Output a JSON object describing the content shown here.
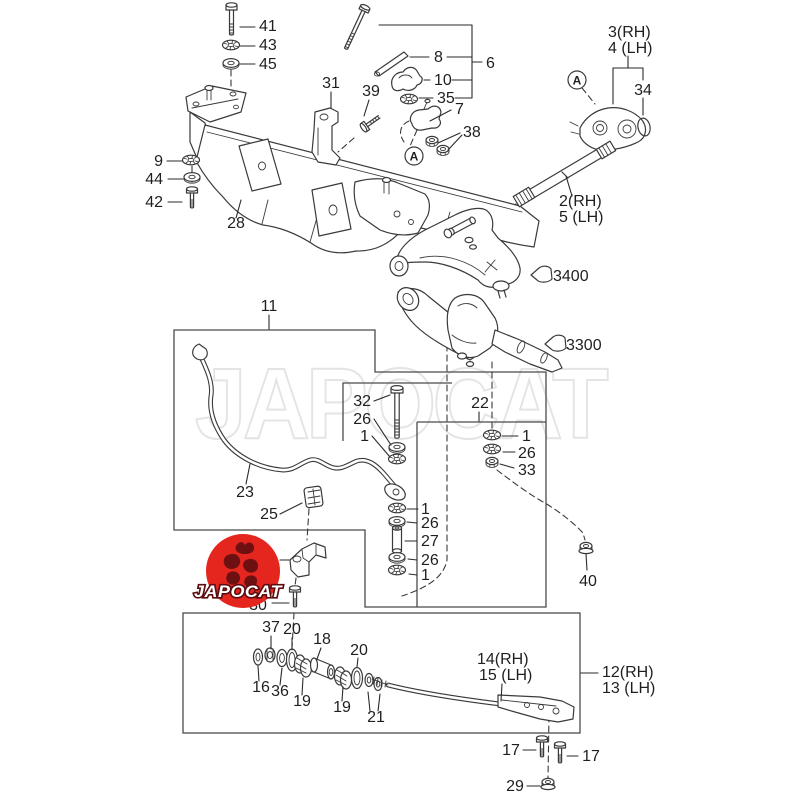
{
  "page": {
    "title": "Front suspension parts diagram",
    "background": "#ffffff"
  },
  "colors": {
    "line": "#3a3a3a",
    "label": "#1f1f1f",
    "box": "#4a4a4a",
    "watermark_gray": "#e4e4e4",
    "logo_red": "#e5261f",
    "logo_dark": "#6e1012",
    "logo_text_fill": "#ffffff"
  },
  "watermark": {
    "text": "JAPOCAT"
  },
  "logo": {
    "text": "JAPOCAT"
  },
  "callouts": {
    "n41": "41",
    "n43": "43",
    "n45": "45",
    "n9": "9",
    "n44": "44",
    "n42": "42",
    "n28": "28",
    "n31": "31",
    "n39": "39",
    "n8": "8",
    "n10": "10",
    "n35": "35",
    "n6": "6",
    "n7": "7",
    "n38": "38",
    "nA1": "A",
    "nA2": "A",
    "n3rh": "3(RH)",
    "n4lh": "4 (LH)",
    "n34": "34",
    "n2rh": "2(RH)",
    "n5lh": "5 (LH)",
    "n3400": "3400",
    "n3300": "3300",
    "n11": "11",
    "n23": "23",
    "n25": "25",
    "n32": "32",
    "n26a": "26",
    "n1a": "1",
    "n22": "22",
    "n1b": "1",
    "n26b": "26",
    "n33": "33",
    "n1c": "1",
    "n26c": "26",
    "n27": "27",
    "n26d": "26",
    "n1d": "1",
    "n40": "40",
    "n30": "30",
    "n37": "37",
    "n20a": "20",
    "n18": "18",
    "n20b": "20",
    "n16": "16",
    "n36": "36",
    "n19a": "19",
    "n19b": "19",
    "n21": "21",
    "n14rh": "14(RH)",
    "n15lh": "15 (LH)",
    "n12rh": "12(RH)",
    "n13lh": "13 (LH)",
    "n17a": "17",
    "n17b": "17",
    "n29": "29"
  }
}
